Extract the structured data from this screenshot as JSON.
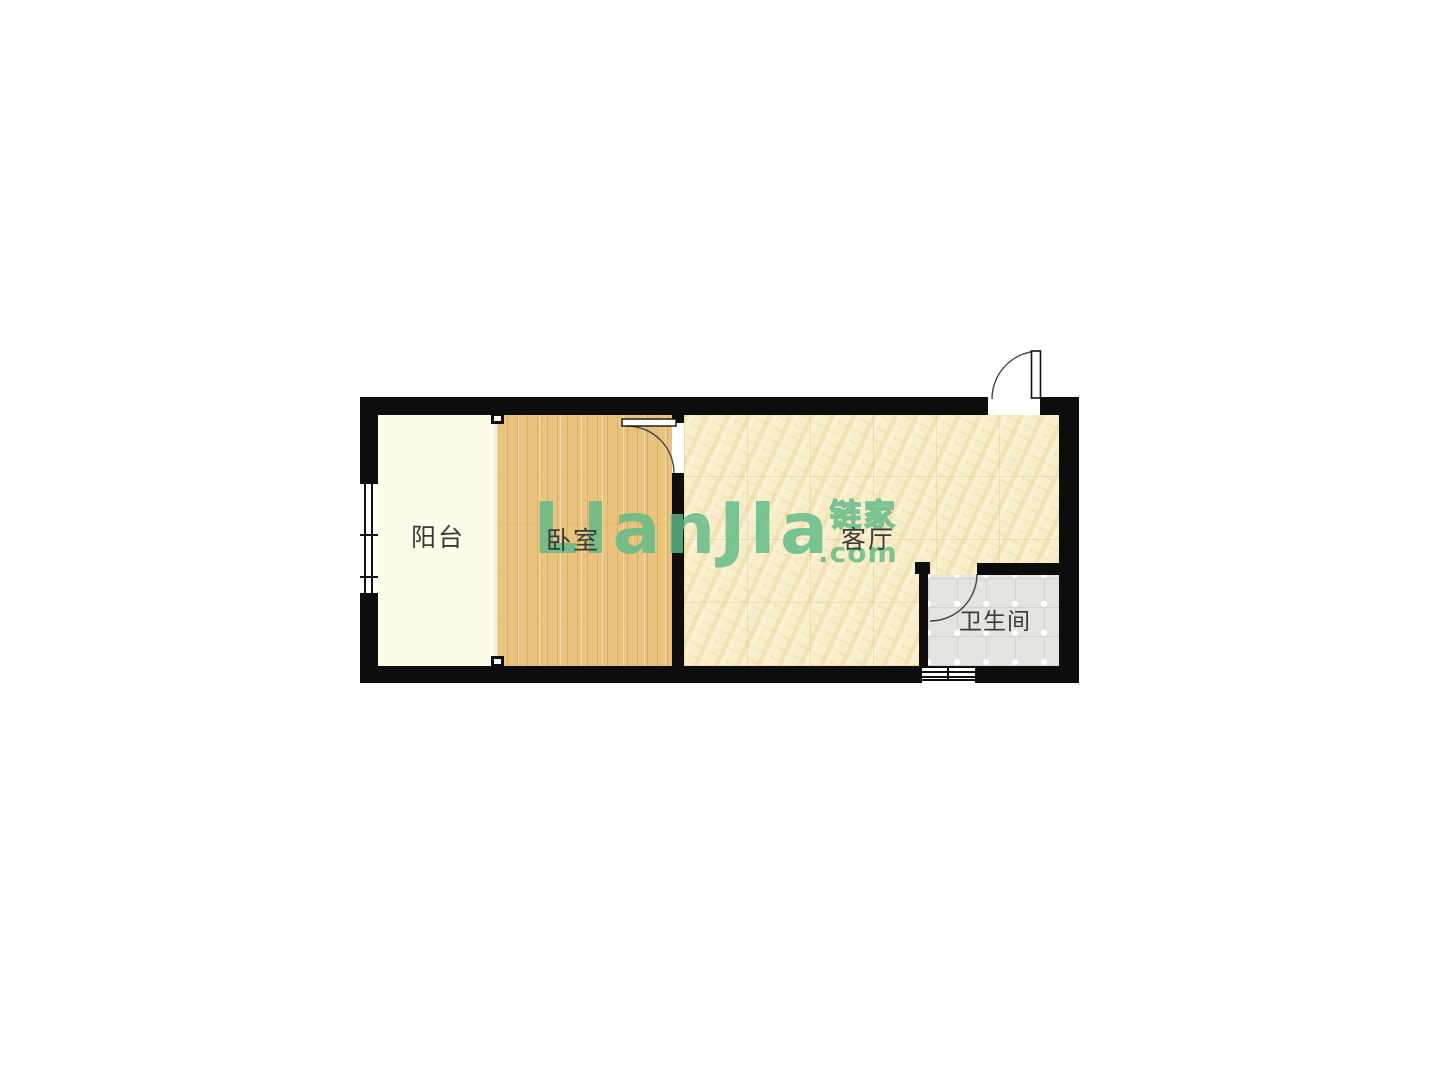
{
  "watermark": {
    "brand_text": "LIanJIa",
    "brand_cn": "链家",
    "brand_domain": ".com"
  },
  "rooms": {
    "balcony": {
      "label": "阳台"
    },
    "bedroom": {
      "label": "卧室"
    },
    "living_room": {
      "label": "客厅"
    },
    "bathroom": {
      "label": "卫生间"
    }
  },
  "colors": {
    "brand_green": "#5fba88",
    "wall_black": "#0d0d0d",
    "balcony_floor": "#fdfce9",
    "bedroom_floor": "#eac47e",
    "living_floor": "#f8eeca",
    "bathroom_floor": "#e3e3df",
    "label_text": "#3a3a3a"
  }
}
